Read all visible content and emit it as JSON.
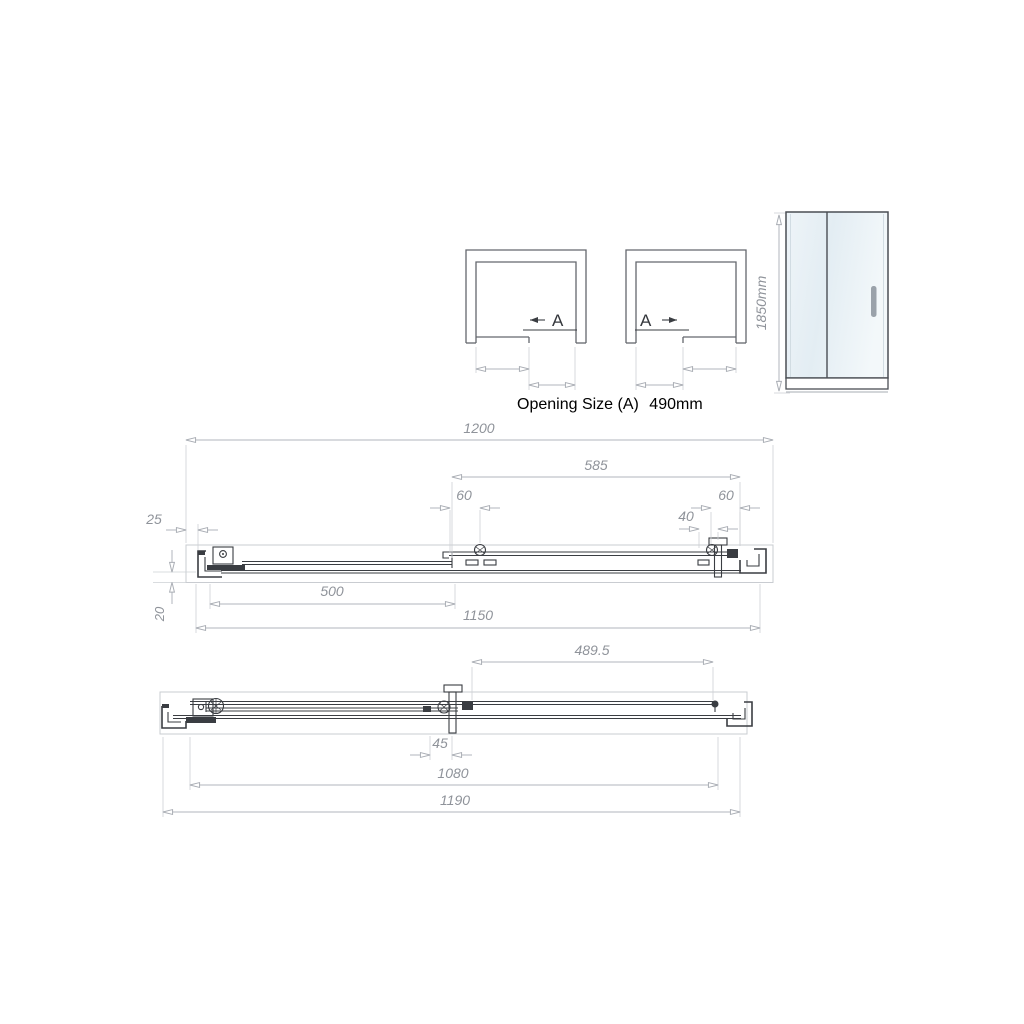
{
  "top_views": {
    "left": {
      "label": "A",
      "direction": "slides-left"
    },
    "right": {
      "label": "A",
      "direction": "slides-right"
    },
    "caption": {
      "label": "Opening Size (A)",
      "value": "490mm"
    }
  },
  "elevation": {
    "height": "1850mm"
  },
  "middle_section": {
    "dims": {
      "overall_width": "1200",
      "sliding_panel_width": "585",
      "left_roller_offset": "60",
      "right_roller_offset": "60",
      "handle_offset": "40",
      "wall_profile_width": "25",
      "fixed_glass_width": "500",
      "inner_width": "1150",
      "profile_depth": "20"
    }
  },
  "bottom_section": {
    "dims": {
      "opening_width": "489.5",
      "handle_clearance": "45",
      "glass_span": "1080",
      "overall_width": "1190"
    }
  },
  "colors": {
    "line_dark": "#3a3d42",
    "line_dim": "#b2b6bc",
    "text_dim": "#8f939a",
    "glass_light": "#f5f9fb",
    "glass_shade": "#dde8ef",
    "handle": "#9aa2aa"
  }
}
